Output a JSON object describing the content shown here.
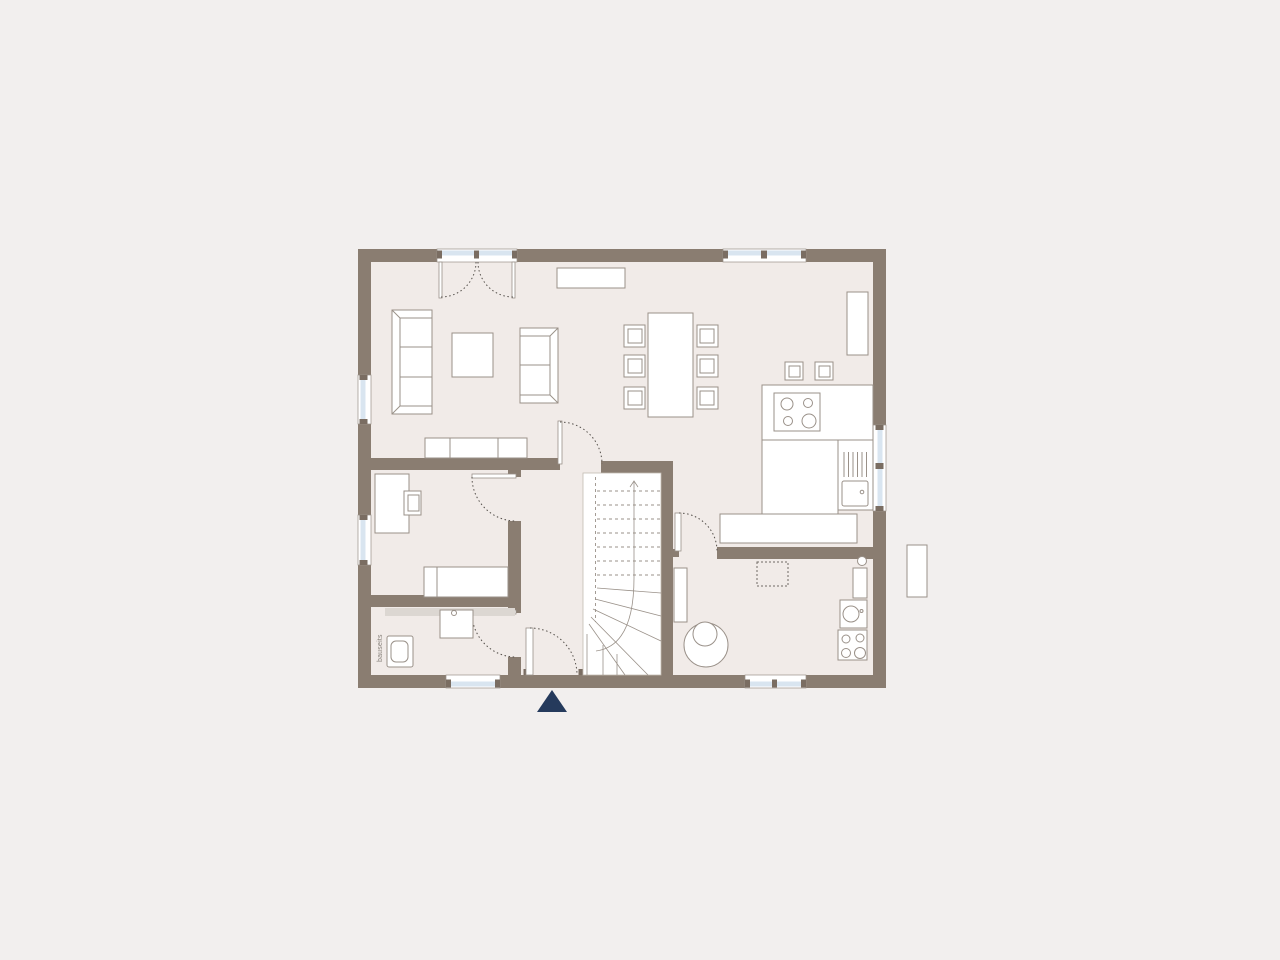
{
  "labels": {
    "bauseits": "bauseits"
  },
  "colors": {
    "bg": "#f2efee",
    "floor": "#f1ebe8",
    "wall": "#8a7d71",
    "glazing": "#d9e5f0",
    "line": "#9a9189",
    "dash": "#55504b",
    "cap": "#7a6d62",
    "accent": "#253a5c",
    "band": "#dcd7d2"
  },
  "plan": {
    "type": "floor-plan",
    "elements": [
      "french-double-door-top",
      "window-top-right",
      "window-left-living",
      "window-left-office",
      "window-right-kitchen",
      "window-bottom-bath",
      "entrance-door-bottom",
      "window-bottom-utility",
      "sofa-3-seat",
      "sofa-2-seat",
      "coffee-table",
      "lowboard",
      "wall-shelf",
      "dining-table",
      "dining-chairs-x6",
      "tall-cabinet",
      "kitchen-counter",
      "cooktop-4-burners",
      "kitchen-island",
      "sink",
      "dish-drainer",
      "kitchen-bench",
      "winder-staircase",
      "walk-line-arrow",
      "desk",
      "desk-chair",
      "bed",
      "vanity-band",
      "washbasin",
      "toilet",
      "boiler-tank",
      "radiator",
      "water-heater",
      "washing-machine",
      "laundry-unit",
      "dashed-reserved-area",
      "outdoor-element",
      "entrance-marker-triangle"
    ]
  }
}
